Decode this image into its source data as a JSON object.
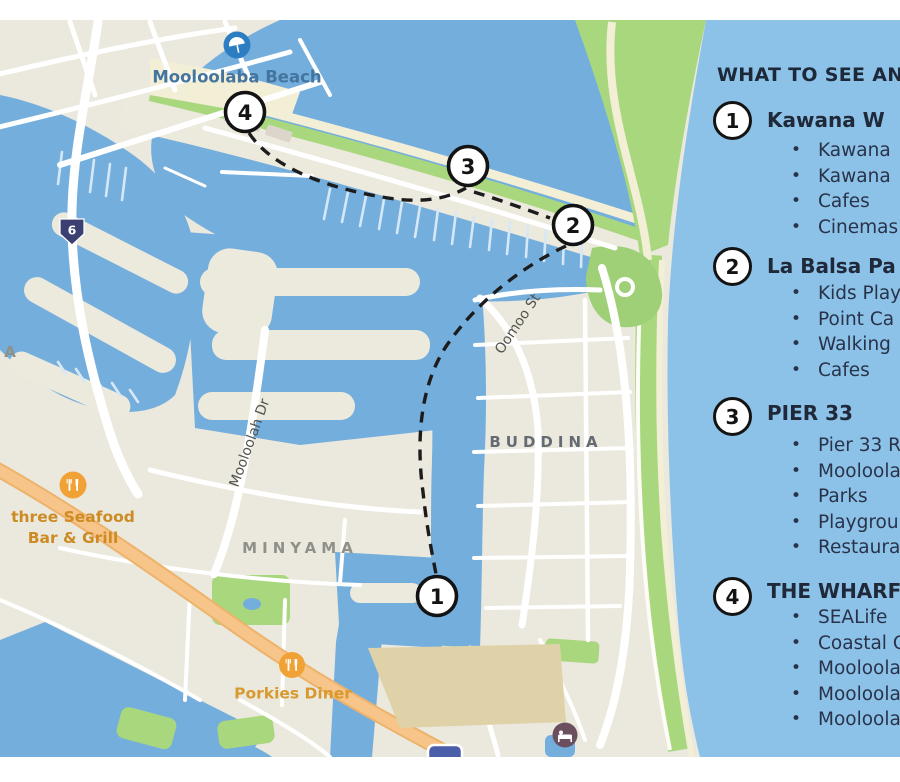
{
  "map": {
    "marker_labels": [
      "1",
      "2",
      "3",
      "4"
    ],
    "route_shield": "6",
    "labels": {
      "beach": "Mooloolaba Beach",
      "suburb_minyama": "MINYAMA",
      "suburb_buddina": "BUDDINA",
      "suburb_partial": "A",
      "street_mooloolah": "Mooloolah Dr",
      "street_oomoo": "Oomoo St",
      "poi_seafood": "three Seafood Bar & Grill",
      "poi_porkies": "Porkies Diner"
    },
    "colors": {
      "water": "#74aedd",
      "ocean": "#8cc1e8",
      "land": "#ebe8dd",
      "park_green": "#a9d77e",
      "sand": "#f3eed6",
      "road_orange": "#f7c489",
      "route_dash": "#1c1c1c",
      "poi_icon_orange": "#f0a236",
      "beach_icon_blue": "#2d7dc2",
      "shield_navy": "#3c3f72",
      "lodging_maroon": "#6b4f5f",
      "transit_blue": "#4b5ea9"
    }
  },
  "panel": {
    "header": "WHAT TO SEE AND",
    "items": [
      {
        "number": "1",
        "title": "Kawana W",
        "bullets": [
          "Kawana",
          "Kawana",
          "Cafes",
          "Cinemas"
        ]
      },
      {
        "number": "2",
        "title": "La Balsa Pa",
        "bullets": [
          "Kids Play",
          "Point Ca",
          "Walking",
          "Cafes"
        ]
      },
      {
        "number": "3",
        "title": "PIER 33",
        "bullets": [
          "Pier 33 Re",
          "Mooloola",
          "Parks",
          "Playgrou",
          "Restaura"
        ]
      },
      {
        "number": "4",
        "title": "THE WHARF",
        "bullets": [
          "SEALife",
          "Coastal C",
          "Mooloola",
          "Mooloola",
          "Mooloola"
        ]
      }
    ]
  }
}
